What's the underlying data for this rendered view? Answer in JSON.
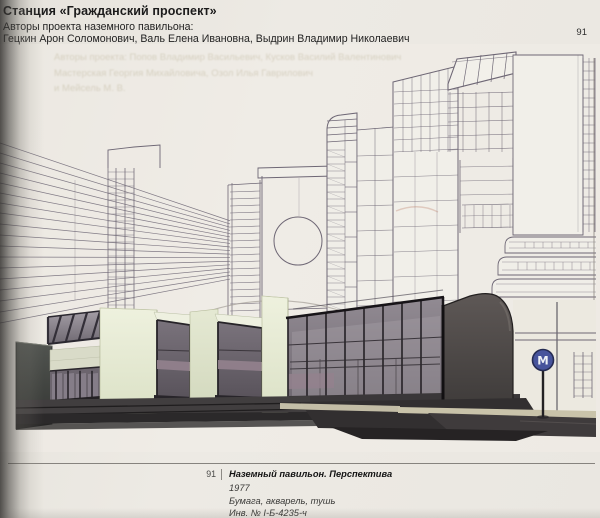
{
  "page": {
    "number": "91"
  },
  "header": {
    "title": "Станция «Гражданский проспект»",
    "subtitle": "Авторы проекта наземного павильона:",
    "authors": "Гецкин Арон Соломонович, Валь Елена Ивановна, Выдрин Владимир Николаевич"
  },
  "showthrough": {
    "line1": "Авторы проекта: Попов Владимир Васильевич, Кусков Василий Валентинович",
    "line2": "Мастерская Георгия Михайловича, Озол Илья Гаврилович",
    "line3": "и Мейсель М. В."
  },
  "artwork": {
    "description": "Перспективный рисунок наземного павильона метро на фоне многоэтажных зданий",
    "metro_sign_letter": "М"
  },
  "caption": {
    "number": "91",
    "title": "Наземный павильон. Перспектива",
    "year": "1977",
    "medium": "Бумага, акварель, тушь",
    "inventory": "Инв. № I-Б-4235-ч"
  },
  "colors": {
    "paper": "#eae7e1",
    "ink_line": "#6e6775",
    "pavilion_cream": "#e7ebd6",
    "glass_dark": "#5f5963",
    "metro_blue": "#47549c",
    "sidewalk_tan": "#c9c3aa"
  }
}
